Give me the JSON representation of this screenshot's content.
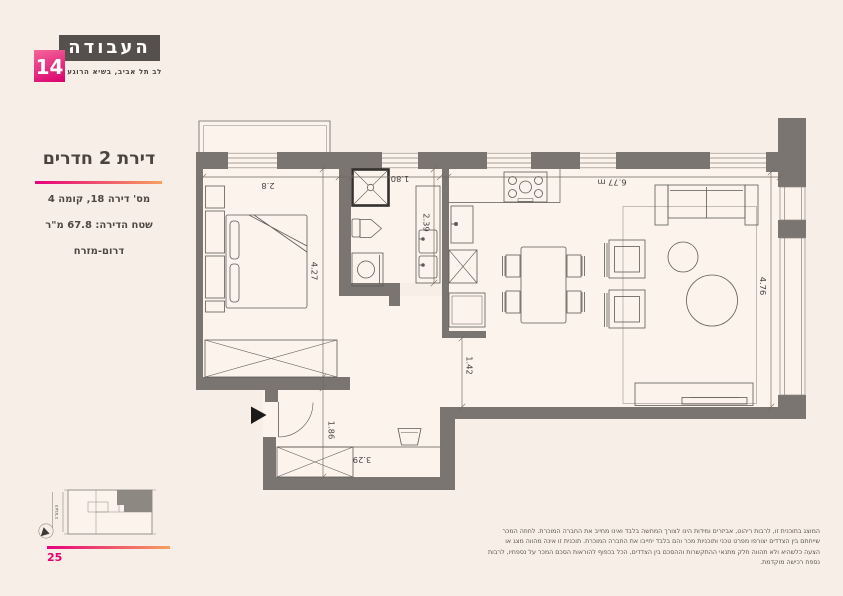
{
  "page": {
    "number": "25"
  },
  "logo": {
    "name": "העבודה",
    "number": "14",
    "tagline": "לב תל אביב, בשיא הרוגע",
    "box_color": "#55504d",
    "accent_gradient": [
      "#e6017c",
      "#f7a05f"
    ],
    "badge_gradient": [
      "#f4679a",
      "#d9006e"
    ]
  },
  "listing": {
    "title": "דירת 2 חדרים",
    "apartment_line": "מס' דירה 18, קומה 4",
    "area_line": "שטח הדירה: 67.8 מ\"ר",
    "orientation_line": "דרום-מזרח"
  },
  "plan": {
    "dimensions": {
      "bedroom_width": "2.8",
      "bedroom_length": "4.27",
      "bathroom_width": "1.80",
      "bathroom_length": "2.39",
      "passage_width": "1.42",
      "entry_length": "1.86",
      "entry_width": "3.29",
      "living_width": "6.77 m",
      "living_length": "4.76"
    }
  },
  "site_plan": {
    "street": "העבודה"
  },
  "disclaimer": {
    "lines": [
      "המוצג בתוכנית זו, לרבות ריהוט, אביזרים ומידות הינו לצורך המחשה בלבד ואינו מחייב את החברה המוכרת. לחוזה המכר",
      "שייחתם בין הצדדים יצורפו מפרט טכני ותוכניות מכר והם בלבד יחייבו את החברה המוכרת. תוכנית זו אינה מהווה מצג או",
      "הצעה כלשהיא ולא תהווה חלק מתנאי ההתקשרות וההסכם בין הצדדים, הכל בכפוף להוראות הסכם המכר על נספחיו, לרבות",
      "נספח רכישה מוקדמת."
    ]
  }
}
